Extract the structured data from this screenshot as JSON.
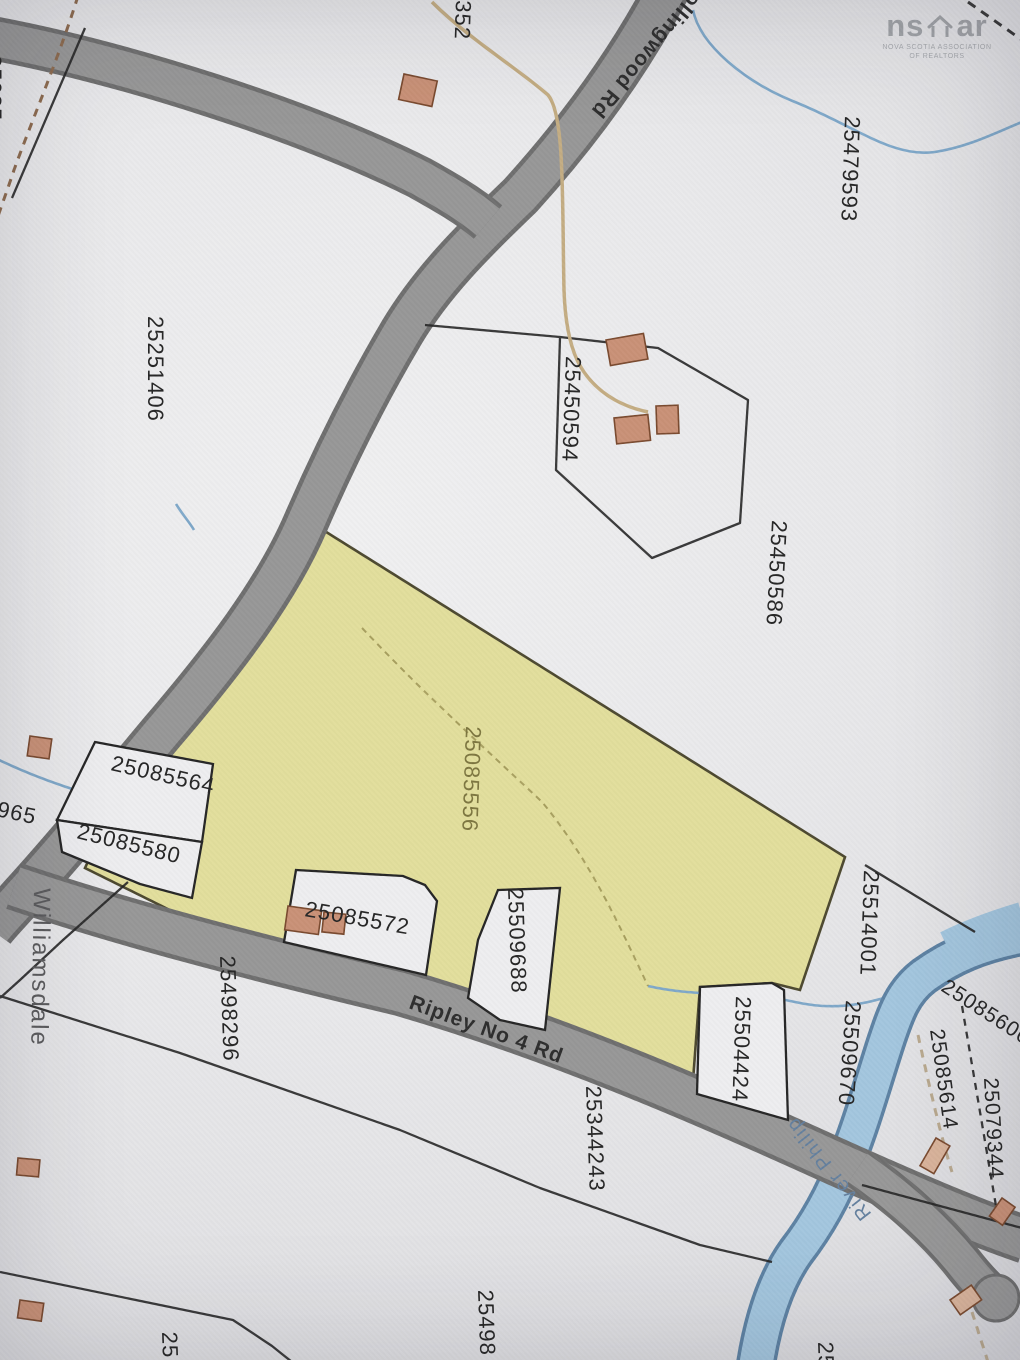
{
  "logo": {
    "brand_prefix": "ns",
    "brand_suffix": "ar",
    "caption_line1": "NOVA SCOTIA ASSOCIATION",
    "caption_line2": "OF REALTORS"
  },
  "roads": {
    "ripley_label": "Ripley No 4 Rd",
    "collingwood_label": "Collingwood Rd"
  },
  "water_label": "River Philip",
  "community_label": "Williamsdale",
  "highlight": {
    "pid": "25085556",
    "color": "#e2de9c"
  },
  "parcels": [
    "25251406",
    "25479593",
    "25450594",
    "25450586",
    "25085556",
    "25085564",
    "25085580",
    "25085572",
    "25509688",
    "25498296",
    "25344243",
    "25504424",
    "25509670",
    "25514001",
    "25085606",
    "25085614",
    "25079344"
  ],
  "partial_labels": [
    "352",
    "965",
    "25085",
    "25498",
    "25",
    "25"
  ],
  "colors": {
    "highlight_parcel": "#e2de9c",
    "road_fill": "#979797",
    "road_casing": "#6f6f6f",
    "water_fill": "#a3c6de",
    "water_edge": "#5d82a3",
    "building_fill": "#c99177",
    "boundary": "#262626",
    "paper": "#e9e9eb"
  }
}
